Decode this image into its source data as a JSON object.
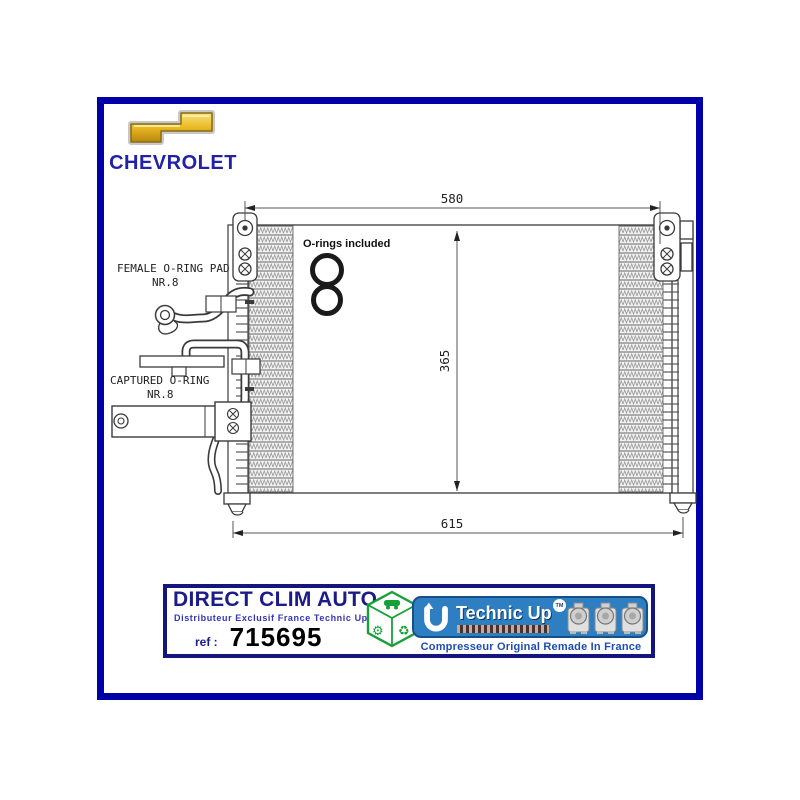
{
  "brand": {
    "name": "CHEVROLET",
    "bowtie_color": "#E6B422",
    "name_color": "#2222A8"
  },
  "frame": {
    "color": "#0000A8"
  },
  "diagram": {
    "dims": {
      "top": "580",
      "side": "365",
      "bottom": "615"
    },
    "orings_note": "O-rings included",
    "female_oring_label": "FEMALE O-RING PAD",
    "female_oring_sub": "NR.8",
    "captured_oring_label": "CAPTURED O-RING",
    "captured_oring_sub": "NR.8"
  },
  "footer": {
    "distributor_name": "DIRECT CLIM AUTO",
    "distributor_tagline": "Distributeur Exclusif France Technic Up",
    "registered_mark": "®",
    "ref_label": "ref :",
    "ref_value": "715695",
    "technicup_name": "Technic Up",
    "trademark": "TM",
    "u_letter": "U",
    "caption": "Compresseur Original Remade In France",
    "cube": {
      "recycle_glyph": "♻",
      "gear_glyph": "⚙"
    }
  },
  "colors": {
    "banner_blue": "#2E7FC2",
    "cube_green": "#18A038",
    "caption_blue": "#1D4DB0",
    "navy": "#1B1B8A"
  }
}
